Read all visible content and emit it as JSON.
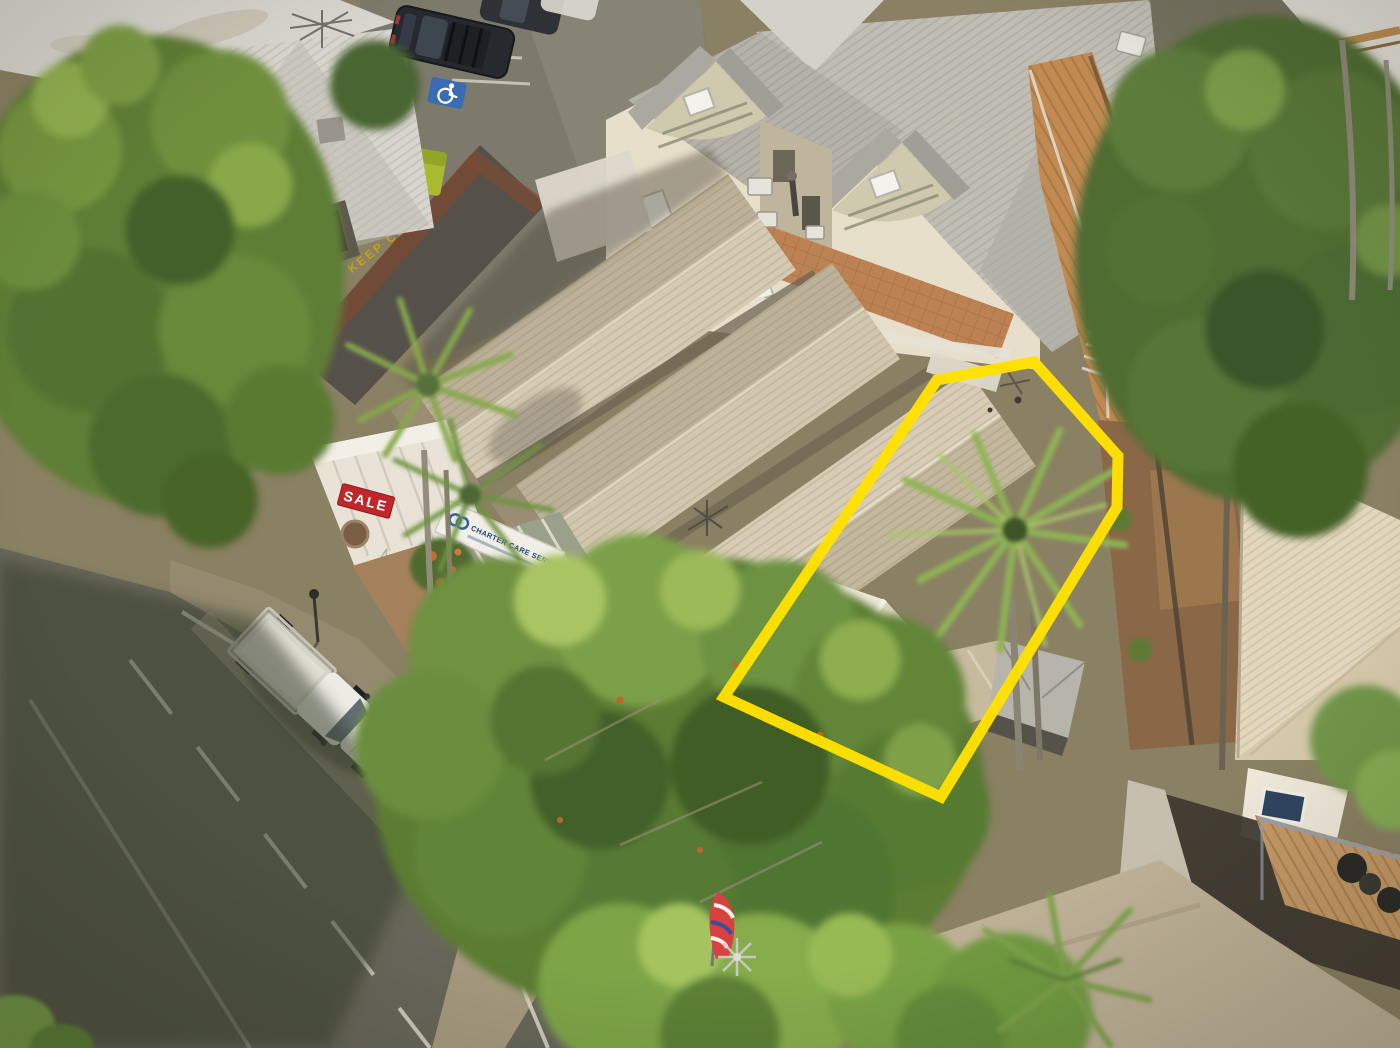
{
  "overlay": {
    "boundary_points": "937,380 1034,362 1118,456 1117,507 941,797 724,697",
    "boundary_color": "#FFE100",
    "boundary_stroke_width": "11"
  },
  "signs": {
    "sale_sign": "SALE",
    "sale_sign_bg": "#C0272D",
    "business_sign": "CHARTER CARE SERVICES",
    "business_sign_color": "#1D3E78",
    "road_marking": "KEEP CLEAR",
    "road_marking_color": "#C9A515"
  },
  "markers": {
    "disabled_parking_bg": "#3A6CB3"
  }
}
